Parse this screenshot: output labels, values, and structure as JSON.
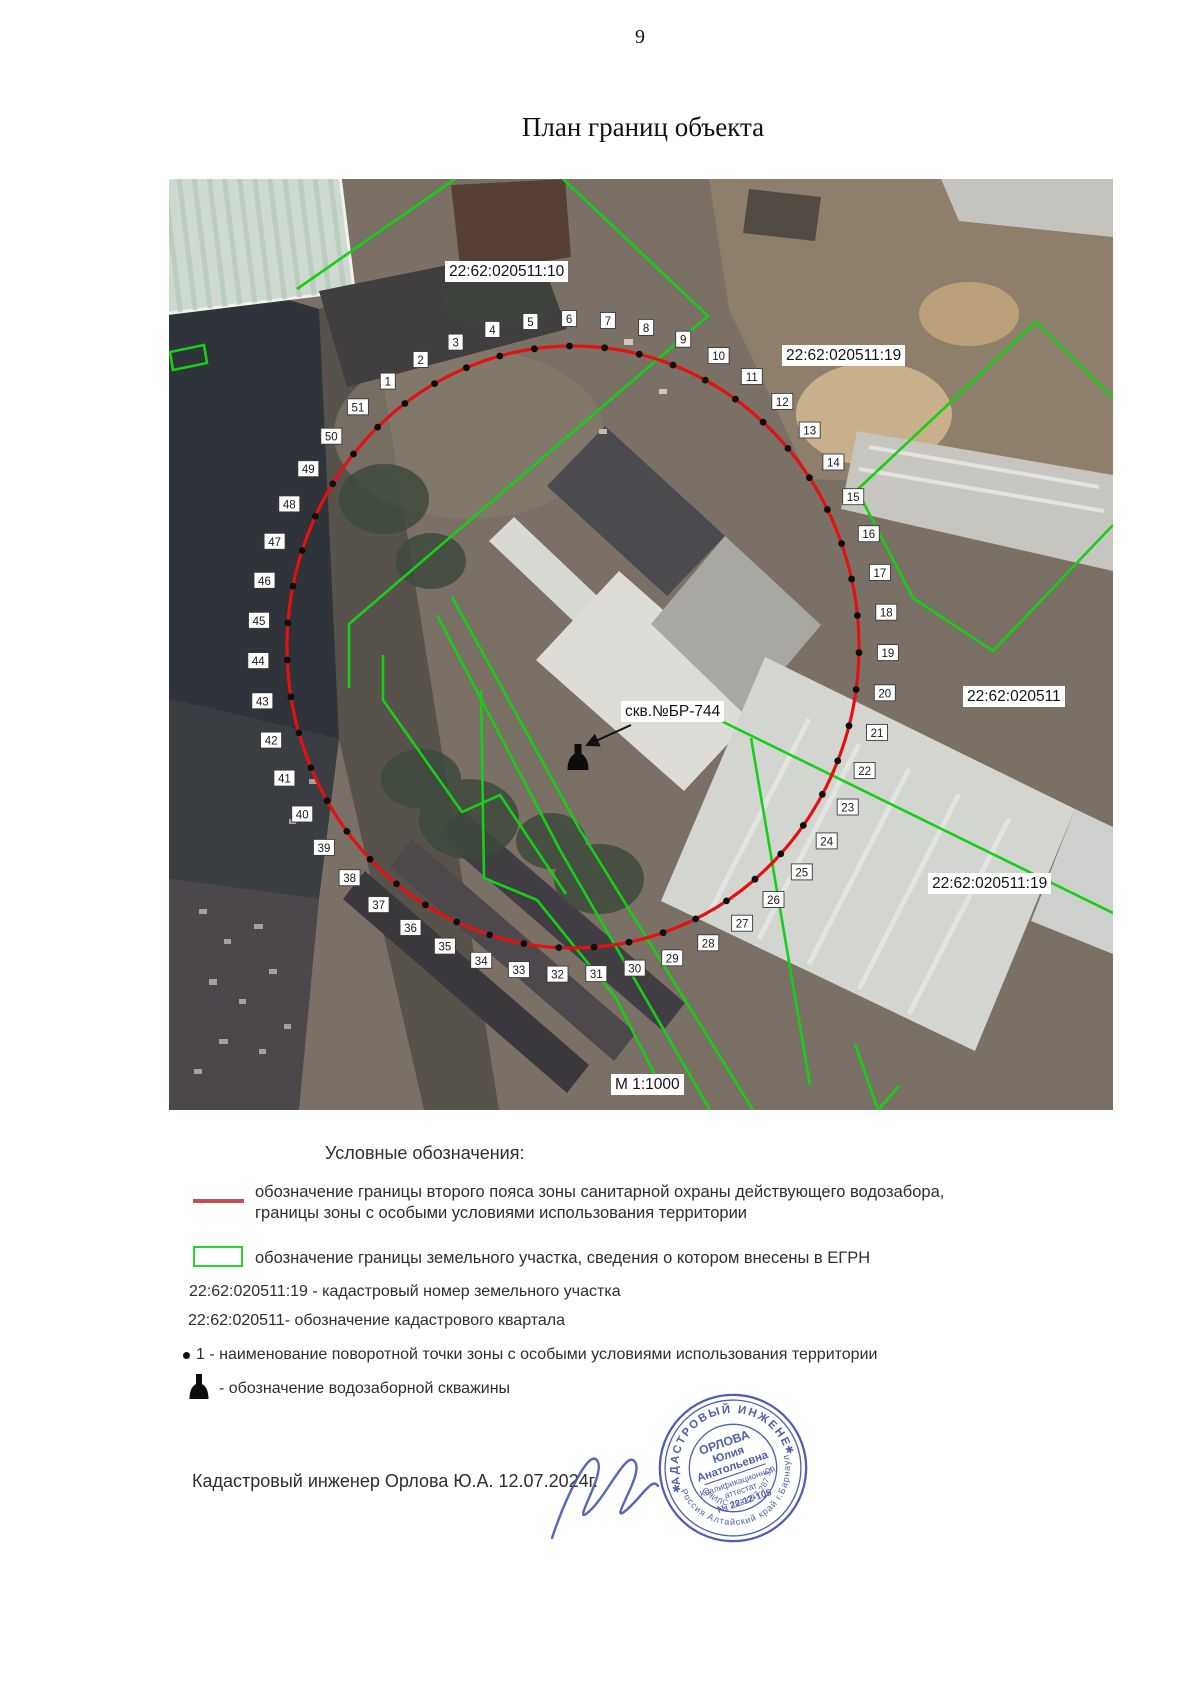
{
  "page": {
    "number": "9",
    "title": "План границ объекта"
  },
  "map": {
    "labels": {
      "parcel_top_left": "22:62:020511:10",
      "parcel_right_top": "22:62:020511:19",
      "cadastral_quarter": "22:62:020511",
      "parcel_bottom_right": "22:62:020511:19",
      "well": "скв.№БР-744",
      "scale": "М 1:1000"
    },
    "zone_color": "#e01212",
    "parcel_color": "#17cf17",
    "points": [
      1,
      2,
      3,
      4,
      5,
      6,
      7,
      8,
      9,
      10,
      11,
      12,
      13,
      14,
      15,
      16,
      17,
      18,
      19,
      20,
      21,
      22,
      23,
      24,
      25,
      26,
      27,
      28,
      29,
      30,
      31,
      32,
      33,
      34,
      35,
      36,
      37,
      38,
      39,
      40,
      41,
      42,
      43,
      44,
      45,
      46,
      47,
      48,
      49,
      50,
      51
    ]
  },
  "legend": {
    "heading": "Условные обозначения:",
    "red_line_1": "обозначение границы второго пояса зоны санитарной охраны действующего водозабора,",
    "red_line_2": "границы зоны с особыми условиями использования территории",
    "green_rect": "обозначение границы земельного участка, сведения о котором внесены в ЕГРН",
    "cad_number": "22:62:020511:19 - кадастровый номер земельного участка",
    "cad_quarter": "22:62:020511- обозначение кадастрового квартала",
    "point_item": "1 - наименование поворотной точки зоны с особыми условиями использования территории",
    "well_item": "- обозначение  водозаборной скважины"
  },
  "footer": {
    "engineer_line": "Кадастровый инженер Орлова Ю.А. 12.07.2024г."
  },
  "stamp": {
    "ring_top": "КАДАСТРОВЫЙ ИНЖЕНЕР",
    "ring_bottom": "Россия Алтайский край г.Барнаул",
    "snils": "СНИЛС 103-097-287 31",
    "name_line1": "ОРЛОВА",
    "name_line2": "Юлия",
    "name_line3": "Анатольевна",
    "cert_line1": "Квалификационный",
    "cert_line2": "аттестат",
    "cert_line3": "№ 22-12-105",
    "color": "#4152a8"
  }
}
